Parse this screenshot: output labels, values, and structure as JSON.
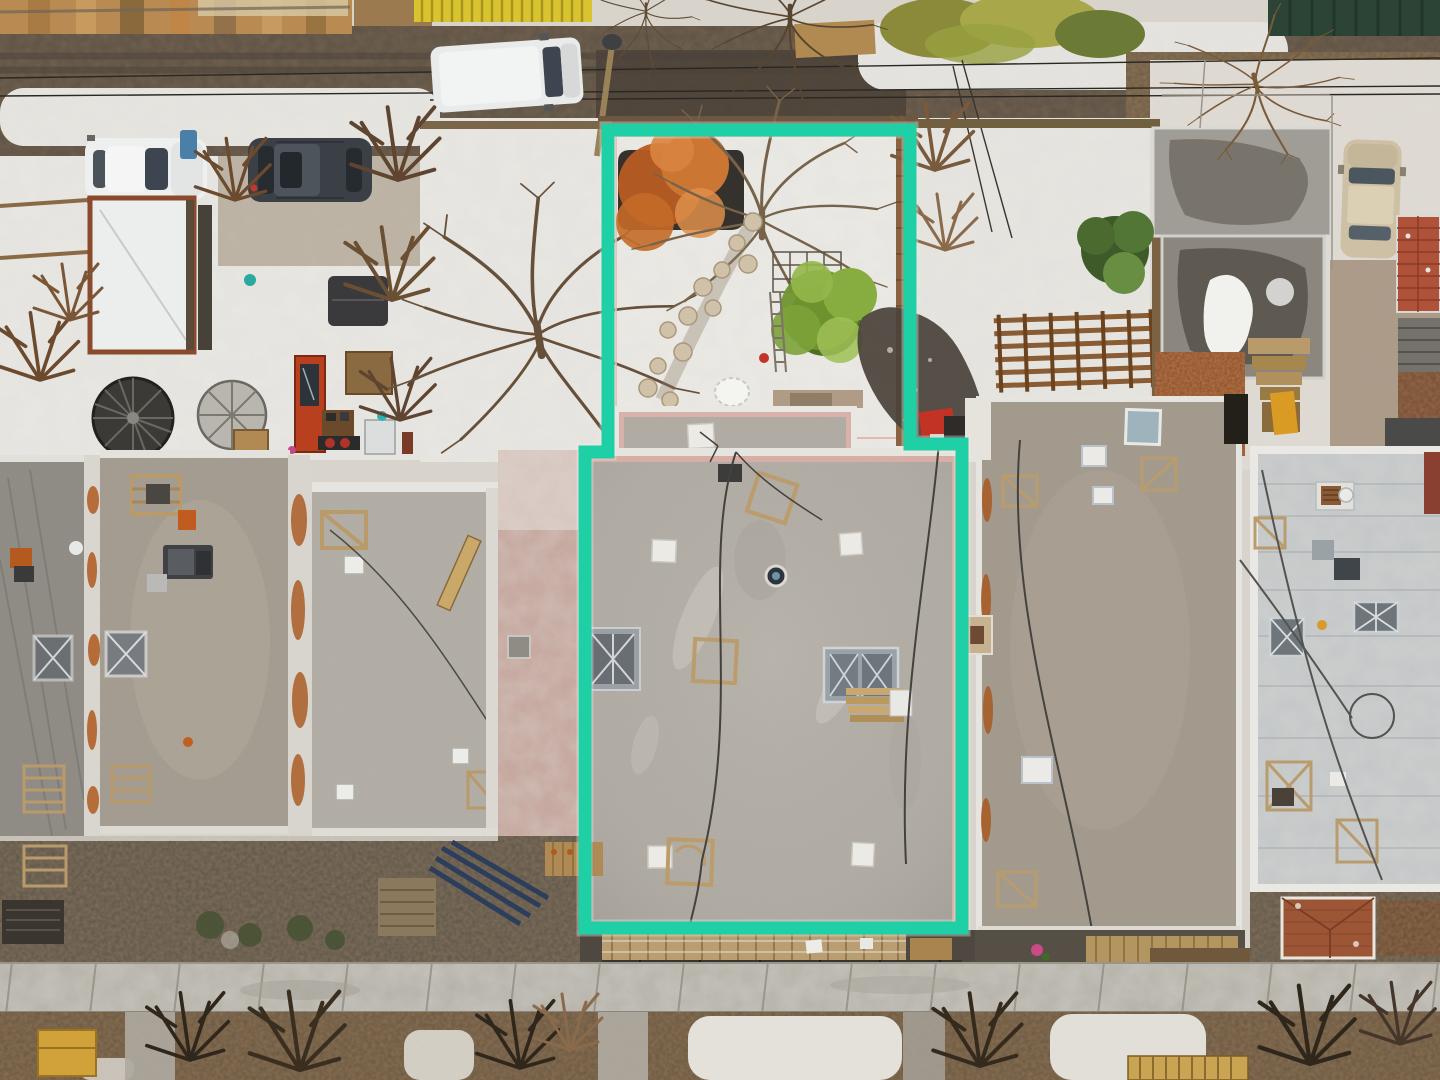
{
  "scene": {
    "type": "aerial-drone-photo",
    "subject": "Top-down winter aerial photo of a block of flat-roof row houses; the middle lot and its backyard are outlined with a teal property boundary line",
    "season": "winter",
    "orientation": "top-down",
    "width_px": 1440,
    "height_px": 1080
  },
  "boundary": {
    "label": "highlighted-property-line",
    "color": "#1fcfa6",
    "shape": "stepped rectangle: narrow backyard at top, wider building footprint below"
  },
  "palette": {
    "asphalt": "#5d5245",
    "asphalt_dark": "#4a4138",
    "snow": "#e9e7e2",
    "snow_bright": "#f3f2ef",
    "wood_deck": "#b98b52",
    "yellow_fence": "#d9c42f",
    "dumpster_green": "#2c4435",
    "dirt": "#6e5b44",
    "garden_soil": "#6a5640",
    "sidewalk": "#b5b1a8",
    "roof_subject": "#b5b0a8",
    "roof_a": "#8f8b85",
    "roof_b": "#a69e91",
    "roof_c": "#b6b2aa",
    "roof_east": "#a59c8e",
    "roof_far_east": "#c3c6c7",
    "parapet_white": "#e6e4de",
    "parapet_pink": "#d6aea6",
    "rust": "#b05a1f",
    "van_white": "#e9eaea",
    "car_white": "#eef0f0",
    "suv_dark": "#3a4046",
    "car_beige": "#cdc0a4",
    "glass": "#3d4650",
    "tree_orange": "#cc7634",
    "tree_green": "#87ac3f",
    "evergreen": "#527635",
    "branches": "#6b5238",
    "terracotta": "#b0513a",
    "door_red": "#b8401f",
    "porch_wood": "#b99e72",
    "pergola_wood": "#8a5c34",
    "shed_frame": "#8a4a2c",
    "pallet_yellow": "#c9a452",
    "wall_pink": "#c4a49a",
    "wet_dark": "#4a423a"
  },
  "objects": [
    "rear-alley-with-snowbanks",
    "overhead-wires",
    "utility-pole",
    "white-van",
    "white-car",
    "dark-suv",
    "snow-covered-shed-roof",
    "two-spiral-staircases",
    "red-door",
    "yellow-slat-fence",
    "green-dumpster",
    "subject-backyard",
    "orange-shrub",
    "bare-trees",
    "stepping-stone-path",
    "green-cedar-tree",
    "trellis",
    "east-pergola",
    "northeast-garage",
    "beige-car",
    "terracotta-tile-roof",
    "evergreen-tree",
    "subject-gravel-roof",
    "skylights",
    "white-roof-vents",
    "wood-pallet-frames",
    "lumber-stack",
    "neighbor-flat-roofs",
    "rusty-parapets",
    "far-east-membrane-roof",
    "front-porches",
    "sidewalk",
    "front-gardens-with-dead-foliage",
    "yellow-pallet",
    "snow-patches"
  ]
}
